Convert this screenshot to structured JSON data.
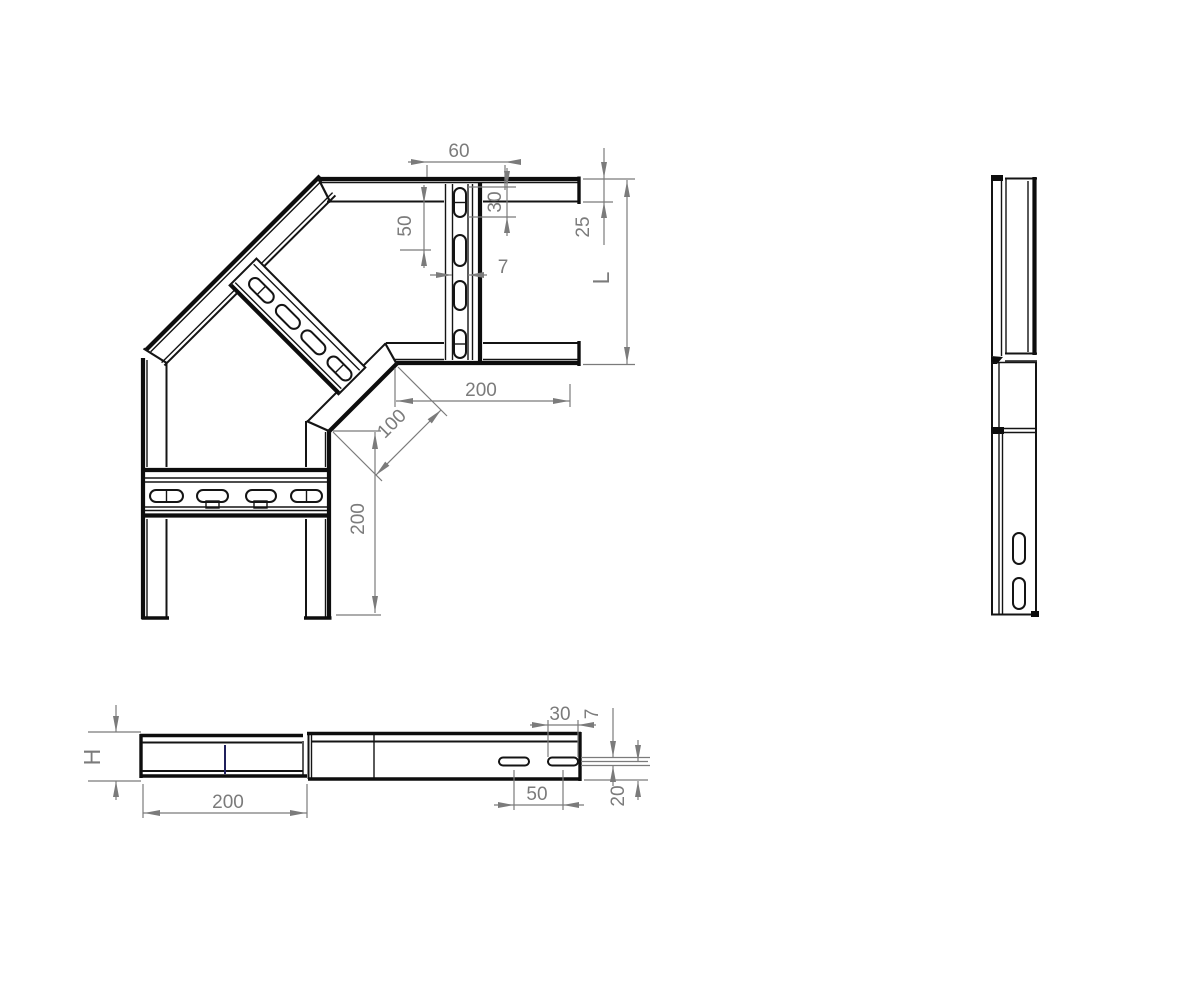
{
  "drawing": {
    "type": "cable-ladder-90-degree-bend-technical-drawing",
    "colors": {
      "line": "#141414",
      "dimension": "#7b7b7b",
      "accent_blue": "#20205c",
      "background": "#ffffff"
    },
    "plan_view": {
      "dims": {
        "top_width": "60",
        "slot_offset": "30",
        "slot_pitch": "50",
        "slot_width": "7",
        "flange_width": "25",
        "ladder_width": "L",
        "arm_length_horizontal": "200",
        "inner_chamfer": "100",
        "arm_length_vertical": "200"
      }
    },
    "front_view": {
      "dims": {
        "rail_height": "H",
        "segment_length": "200",
        "slot_length": "30",
        "slot_height": "7",
        "slot_pitch": "50",
        "slot_bottom_offset": "20"
      }
    }
  }
}
